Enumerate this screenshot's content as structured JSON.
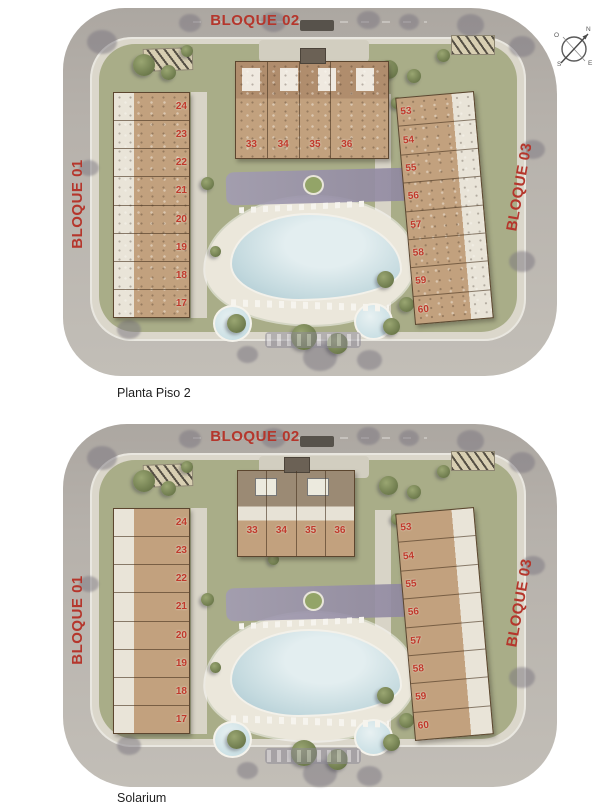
{
  "compass": {
    "north": "N",
    "south": "S",
    "east": "E",
    "west": "O"
  },
  "plans": [
    {
      "title": "Planta Piso 2",
      "blocks": {
        "bloque01": {
          "label": "BLOQUE 01",
          "units": [
            "24",
            "23",
            "22",
            "21",
            "20",
            "19",
            "18",
            "17"
          ]
        },
        "bloque02": {
          "label": "BLOQUE 02",
          "units": [
            "33",
            "34",
            "35",
            "36"
          ]
        },
        "bloque03": {
          "label": "BLOQUE 03",
          "units": [
            "53",
            "54",
            "55",
            "56",
            "57",
            "58",
            "59",
            "60"
          ]
        }
      }
    },
    {
      "title": "Solarium",
      "blocks": {
        "bloque01": {
          "label": "BLOQUE 01",
          "units": [
            "24",
            "23",
            "22",
            "21",
            "20",
            "19",
            "18",
            "17"
          ]
        },
        "bloque02": {
          "label": "BLOQUE 02",
          "units": [
            "33",
            "34",
            "35",
            "36"
          ]
        },
        "bloque03": {
          "label": "BLOQUE 03",
          "units": [
            "53",
            "54",
            "55",
            "56",
            "57",
            "58",
            "59",
            "60"
          ]
        }
      }
    }
  ],
  "theme": {
    "label_red": "#b5362c",
    "unit_red": "#c0392b",
    "road_gray": "#b6b1ab",
    "lawn_green": "#a9ad88",
    "roof_tan": "#c2a17e",
    "pool_blue": "#c3d9de",
    "shade_purple": "#a29cb2",
    "page_bg": "#ffffff"
  }
}
